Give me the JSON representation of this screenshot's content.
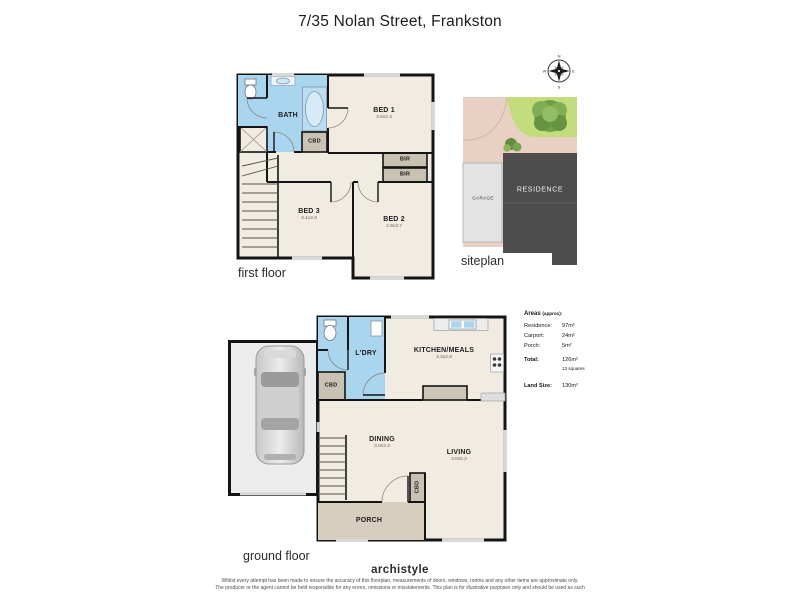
{
  "title": "7/35 Nolan Street, Frankston",
  "first_floor": {
    "label": "first floor",
    "rooms": {
      "bath": {
        "name": "BATH"
      },
      "bed1": {
        "name": "BED 1",
        "dims": "3.6x2.4"
      },
      "cbd": {
        "name": "CBD"
      },
      "bir1": {
        "name": "BIR"
      },
      "bir2": {
        "name": "BIR"
      },
      "bed3": {
        "name": "BED 3",
        "dims": "3.1x2.8"
      },
      "bed2": {
        "name": "BED 2",
        "dims": "2.9x3.7"
      }
    }
  },
  "ground_floor": {
    "label": "ground floor",
    "rooms": {
      "ldry": {
        "name": "L'DRY"
      },
      "cbd1": {
        "name": "CBD"
      },
      "kitchen": {
        "name": "KITCHEN/MEALS",
        "dims": "4.3x2.8"
      },
      "dining": {
        "name": "DINING",
        "dims": "3.0x3.3"
      },
      "living": {
        "name": "LIVING",
        "dims": "3.0x5.3"
      },
      "cbd2": {
        "name": "CBD"
      },
      "porch": {
        "name": "PORCH"
      }
    }
  },
  "siteplan": {
    "label": "siteplan",
    "garage": "GARAGE",
    "residence": "RESIDENCE",
    "compass": {
      "n": "N",
      "e": "E",
      "s": "S",
      "w": "W"
    }
  },
  "areas": {
    "heading_main": "Areas",
    "heading_sub": "(approx):",
    "rows": [
      {
        "label": "Residence:",
        "value": "97m²"
      },
      {
        "label": "Carport:",
        "value": "24m²"
      },
      {
        "label": "Porch:",
        "value": "5m²"
      }
    ],
    "total_label": "Total:",
    "total_value": "126m²",
    "total_squares": "13 squares",
    "land_label": "Land Size:",
    "land_value": "130m²"
  },
  "footer": {
    "brand": "archistyle",
    "disclaimer_line1": "Whilst every attempt has been made to ensure the accuracy of this floorplan, measurements of doors, windows, rooms and any other items are approximate only.",
    "disclaimer_line2": "The producer or the agent cannot be held responsible for any errors, omissions or misstatements. This plan is for illustrative purposes only and should be used as such"
  },
  "colors": {
    "wall": "#141414",
    "floor_cream": "#f1ece1",
    "wet_area_blue": "#a9d5ef",
    "cabinet_gray": "#c9c1b2",
    "porch_tan": "#d8cec0",
    "site_ground": "#e8d1c2",
    "grass_green": "#c3dd7c",
    "residence_gray": "#4d4d4d",
    "site_garage_gray": "#e3e3e3"
  }
}
